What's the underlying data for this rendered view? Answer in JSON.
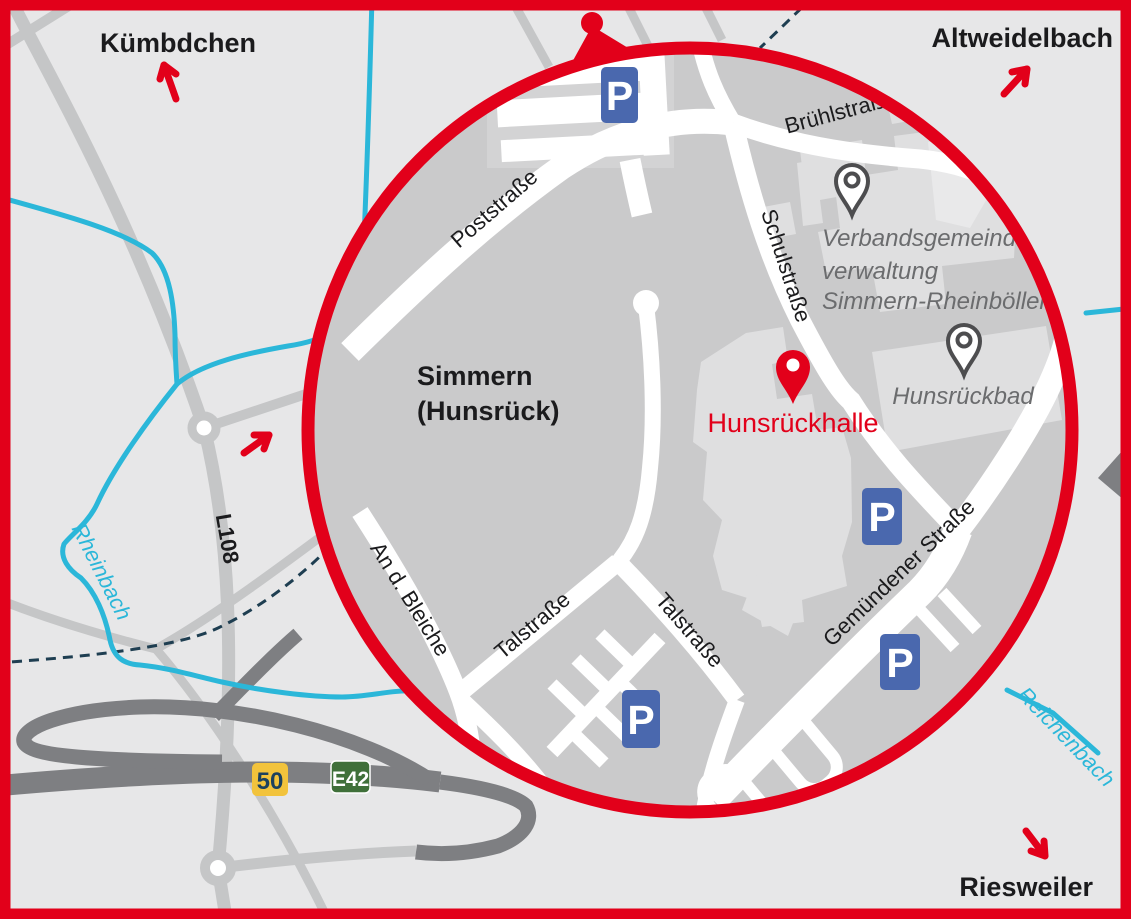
{
  "map": {
    "regions": {
      "top_left": "Kümbdchen",
      "top_right": "Altweidelbach",
      "bottom_right": "Riesweiler"
    },
    "town": {
      "line1": "Simmern",
      "line2": "(Hunsrück)"
    },
    "venue": {
      "name": "Hunsrückhalle"
    },
    "administration": {
      "line1": "Verbandsgemeinde-",
      "line2": "verwaltung",
      "line3": "Simmern-Rheinböllen"
    },
    "bath": {
      "name": "Hunsrückbad"
    },
    "streets": {
      "post": "Poststraße",
      "bruehl": "Brühlstraße",
      "schul": "Schulstraße",
      "bleiche": "An d. Bleiche",
      "tal_west": "Talstraße",
      "tal_east": "Talstraße",
      "gemuendener": "Gemündener Straße",
      "l108": "L108"
    },
    "rivers": {
      "west": "Rheinbach",
      "southeast": "Reichenbach"
    },
    "road_badges": {
      "b50": "50",
      "e42": "E42"
    },
    "parking": {
      "symbol": "P"
    },
    "colors": {
      "accent_red": "#e2001a",
      "river_cyan": "#2bb7d9",
      "parking_blue": "#4a68ae",
      "badge_yellow": "#f2c33c",
      "badge_green": "#40703a"
    }
  }
}
